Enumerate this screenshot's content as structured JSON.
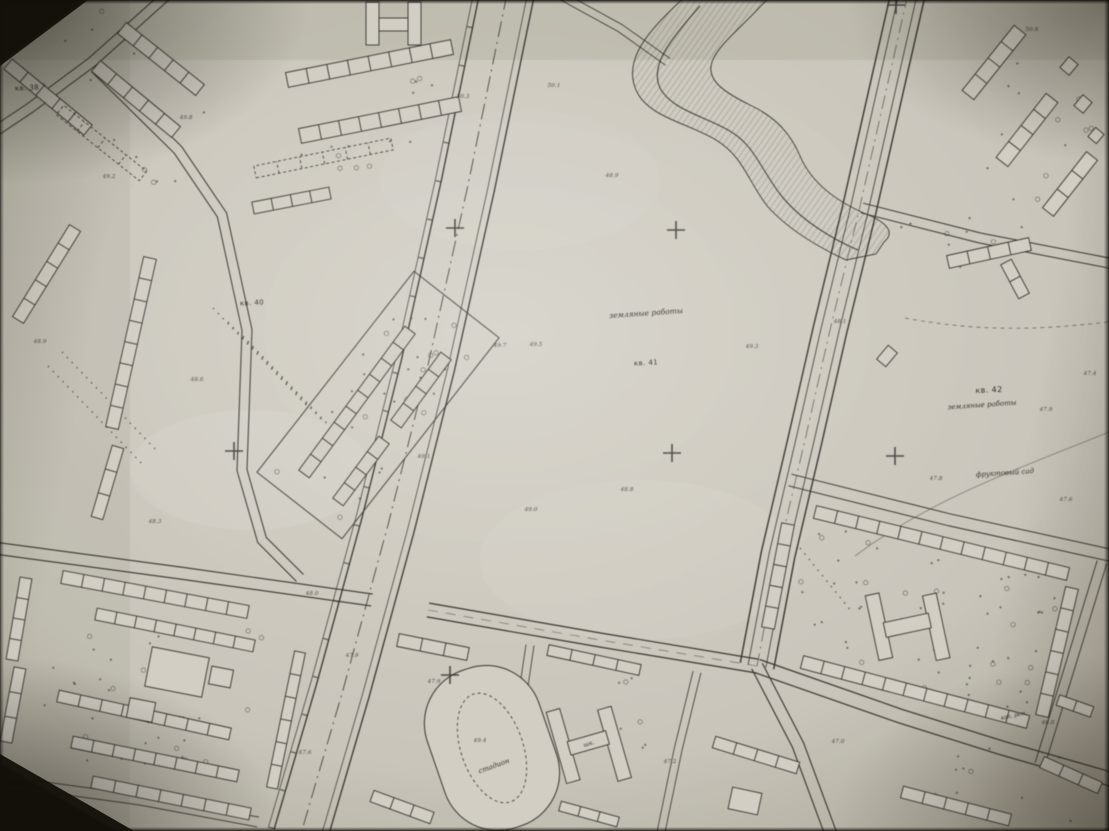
{
  "photo": {
    "colors": {
      "paper": "#d8d5cc",
      "ink": "#34332e",
      "photo_edge": "#14110a"
    }
  },
  "map": {
    "quarter_labels": [
      {
        "text": "кв. 38",
        "x": 27,
        "y": 88,
        "rot": -3,
        "size": 7
      },
      {
        "text": "кв. 40",
        "x": 252,
        "y": 303,
        "rot": -3,
        "size": 7
      },
      {
        "text": "кв. 41",
        "x": 646,
        "y": 363,
        "rot": -3,
        "size": 7
      },
      {
        "text": "кв. 42",
        "x": 989,
        "y": 390,
        "rot": -3,
        "size": 8
      }
    ],
    "area_labels": [
      {
        "text": "земляные работы",
        "x": 646,
        "y": 313,
        "rot": -4,
        "size": 7.5
      },
      {
        "text": "земляные работы",
        "x": 982,
        "y": 405,
        "rot": -4,
        "size": 7
      },
      {
        "text": "фруктовый сад",
        "x": 1005,
        "y": 473,
        "rot": -4,
        "size": 7
      },
      {
        "text": "стадион",
        "x": 494,
        "y": 766,
        "rot": -20,
        "size": 7
      },
      {
        "text": "шк.",
        "x": 589,
        "y": 744,
        "rot": -16,
        "size": 6
      },
      {
        "text": "кап. рем.",
        "x": 1014,
        "y": 716,
        "rot": -12,
        "size": 5.5
      }
    ],
    "spot_heights": [
      {
        "text": "49.8",
        "x": 186,
        "y": 118
      },
      {
        "text": "49.2",
        "x": 109,
        "y": 177
      },
      {
        "text": "48.9",
        "x": 40,
        "y": 342
      },
      {
        "text": "48.6",
        "x": 197,
        "y": 380
      },
      {
        "text": "48.3",
        "x": 155,
        "y": 522
      },
      {
        "text": "48.0",
        "x": 312,
        "y": 594
      },
      {
        "text": "47.9",
        "x": 352,
        "y": 656
      },
      {
        "text": "47.6",
        "x": 305,
        "y": 753
      },
      {
        "text": "50.3",
        "x": 463,
        "y": 97
      },
      {
        "text": "49.7",
        "x": 500,
        "y": 346
      },
      {
        "text": "49.1",
        "x": 424,
        "y": 457
      },
      {
        "text": "49.5",
        "x": 536,
        "y": 345
      },
      {
        "text": "49.0",
        "x": 531,
        "y": 510
      },
      {
        "text": "48.8",
        "x": 627,
        "y": 490
      },
      {
        "text": "49.3",
        "x": 752,
        "y": 347
      },
      {
        "text": "48.9",
        "x": 612,
        "y": 176
      },
      {
        "text": "50.1",
        "x": 554,
        "y": 86
      },
      {
        "text": "48.1",
        "x": 840,
        "y": 322
      },
      {
        "text": "47.9",
        "x": 1046,
        "y": 410
      },
      {
        "text": "47.8",
        "x": 936,
        "y": 479
      },
      {
        "text": "47.6",
        "x": 1066,
        "y": 500
      },
      {
        "text": "47.4",
        "x": 1090,
        "y": 374
      },
      {
        "text": "47.9",
        "x": 434,
        "y": 682
      },
      {
        "text": "49.4",
        "x": 480,
        "y": 741
      },
      {
        "text": "47.2",
        "x": 670,
        "y": 762
      },
      {
        "text": "47.0",
        "x": 838,
        "y": 742
      },
      {
        "text": "46.8",
        "x": 1048,
        "y": 723
      },
      {
        "text": "50.8",
        "x": 1032,
        "y": 30
      }
    ],
    "grid_crosses": [
      {
        "x": 896,
        "y": 5
      },
      {
        "x": 455,
        "y": 228
      },
      {
        "x": 676,
        "y": 230
      },
      {
        "x": 234,
        "y": 451
      },
      {
        "x": 672,
        "y": 453
      },
      {
        "x": 895,
        "y": 456
      },
      {
        "x": 450,
        "y": 675
      }
    ]
  }
}
